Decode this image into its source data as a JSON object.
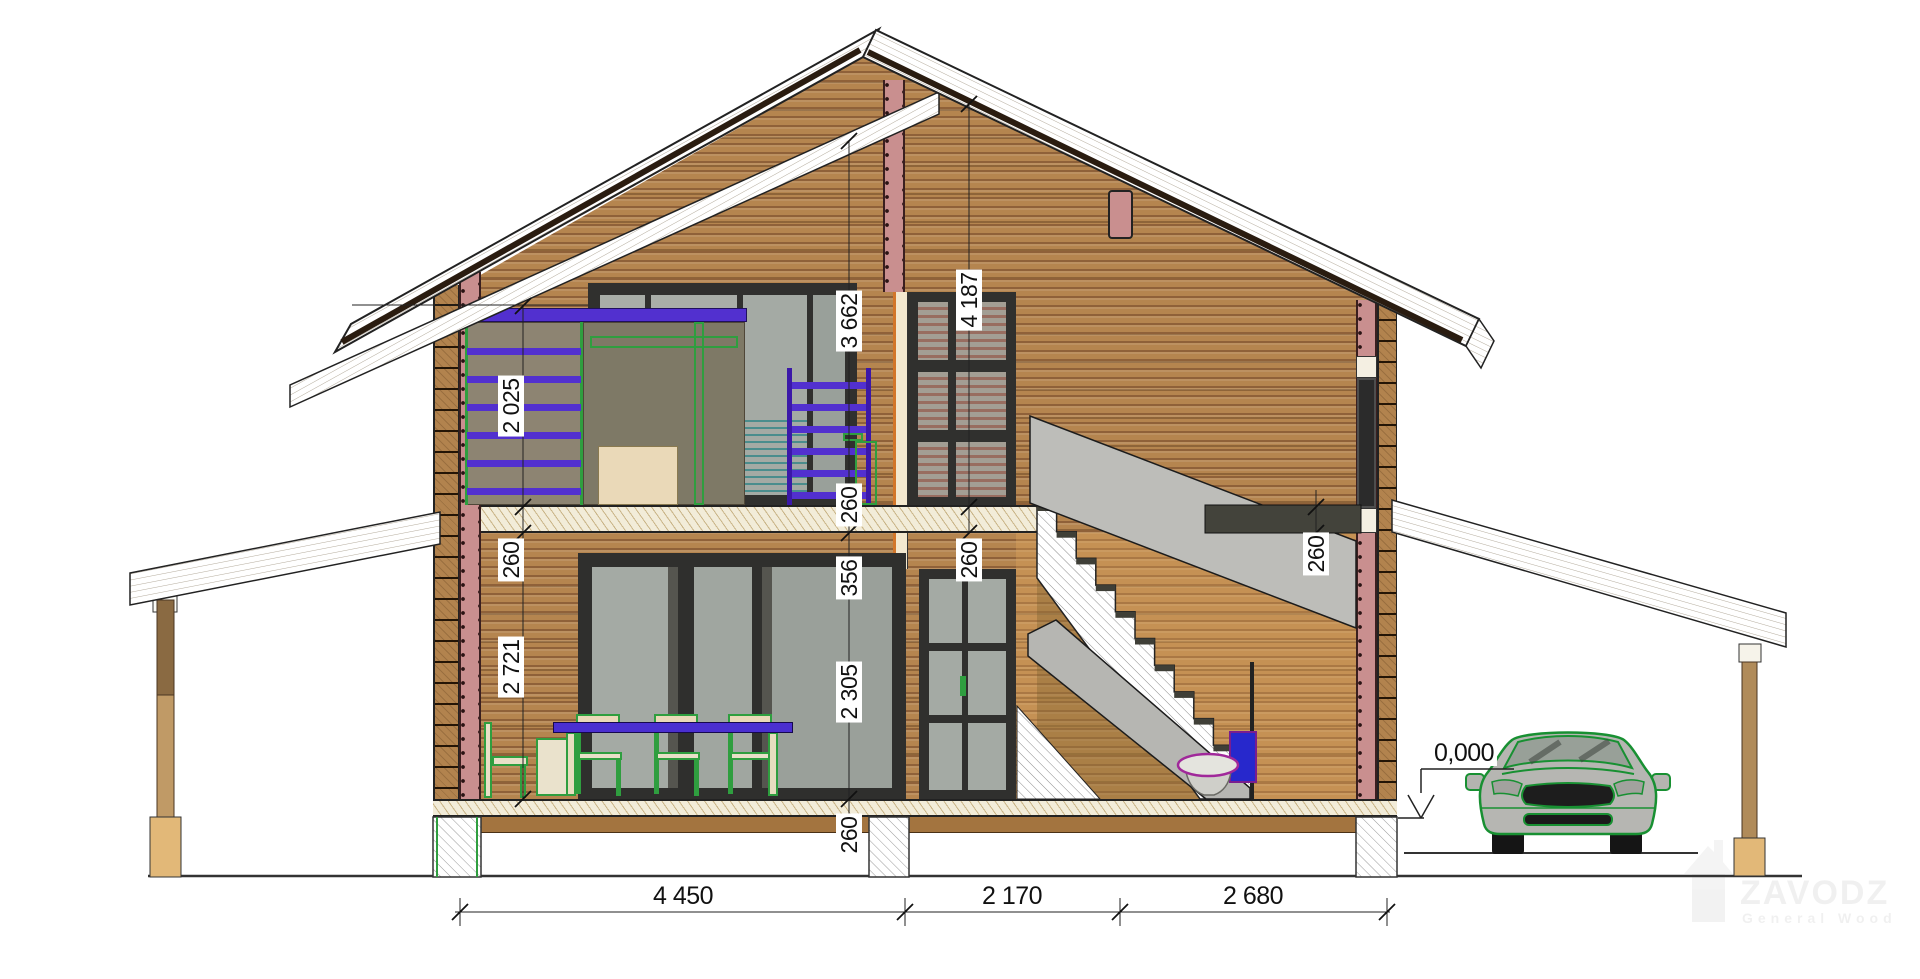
{
  "dims": {
    "left": [
      "2 025",
      "260",
      "2 721"
    ],
    "middle": [
      "3 662",
      "260",
      "356",
      "2 305",
      "260"
    ],
    "window": [
      "4 187",
      "260"
    ],
    "stairs": [
      "260"
    ],
    "bottom": [
      "4 450",
      "2 170",
      "2 680"
    ],
    "level": "0,000"
  },
  "watermark": {
    "title": "ZAVODZ",
    "subtitle": "General Wood"
  },
  "colors": {
    "wall": "#b5854f",
    "wall_joint": "#8f6139",
    "insulation": "#c98f8f",
    "floor_hatch": "#f2ecd9",
    "stair_gray": "#bdbdb9",
    "slab_dark": "#43433b",
    "furniture_purple": "#5230cf",
    "furniture_green": "#2f9e3f",
    "table_blue": "#4a2fd0",
    "toilet_tank": "#2728cc",
    "toilet_outline": "#a0289a",
    "car_outline": "#189032",
    "glass": "#a4aaa4",
    "roof_dark_edge": "#2a1c10",
    "post_wood": "#b08b5a"
  }
}
